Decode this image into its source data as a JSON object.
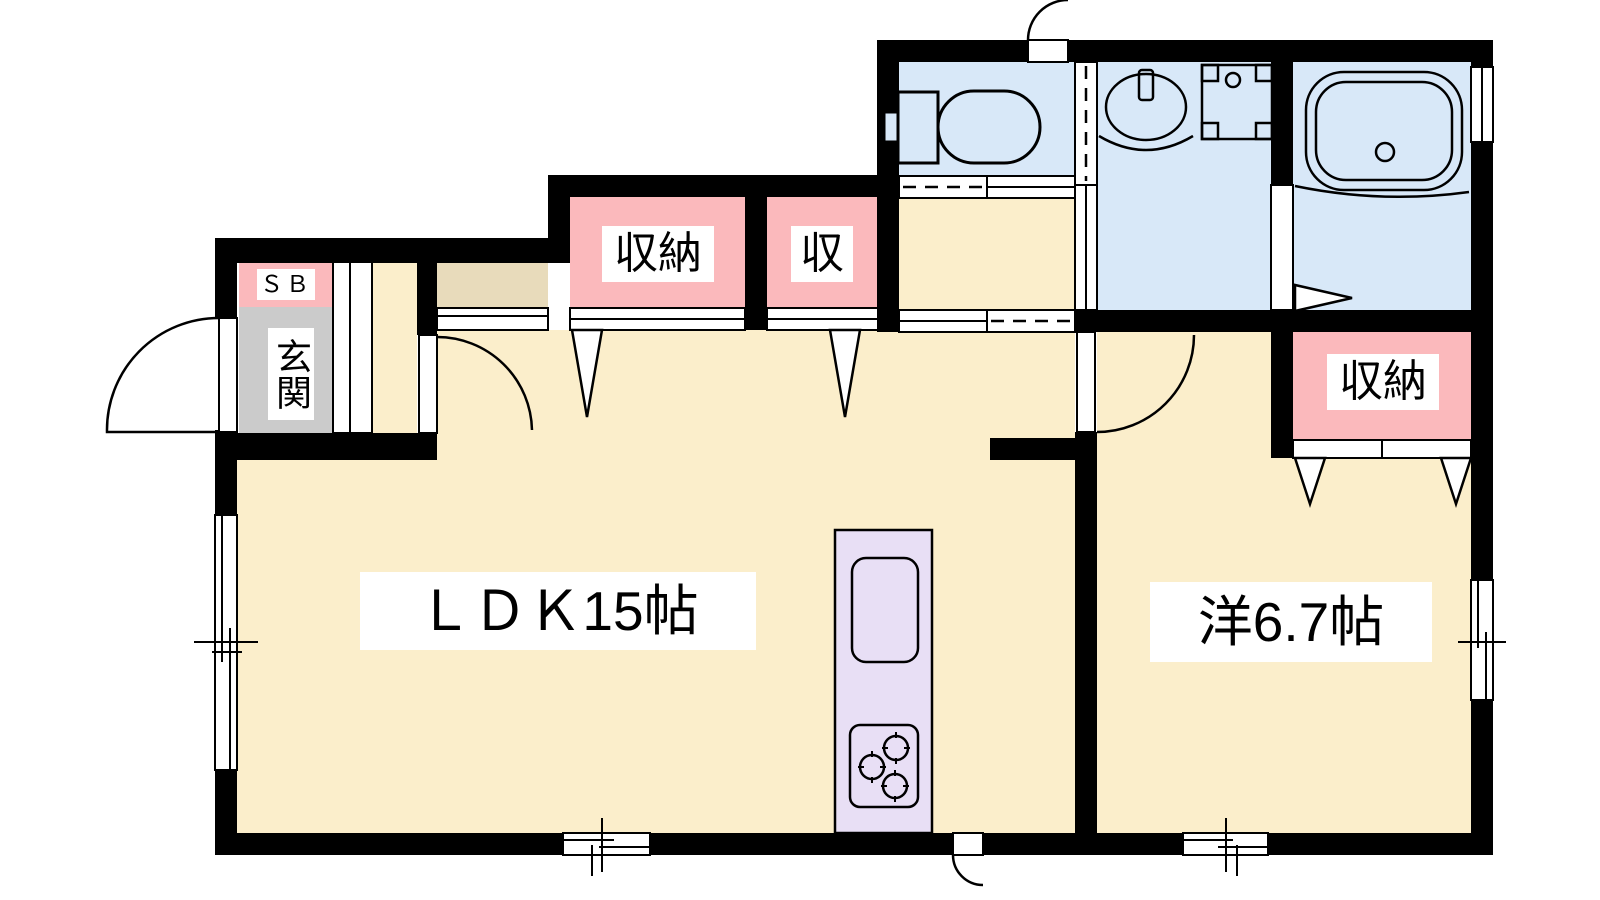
{
  "title": "1LDK floor plan",
  "colors": {
    "bg": "#FFFFFF",
    "wall": "#000000",
    "line": "#000000",
    "floor": "#FBEECB",
    "wet": "#D8E8F8",
    "closet": "#FBB9BC",
    "entrance": "#CBCBCB",
    "step": "#E8DBBB",
    "counter": "#E8DFF5",
    "label_bg": "#FFFFFF",
    "label_text": "#000000"
  },
  "rooms": {
    "ldk": {
      "label": "ＬＤＫ15帖"
    },
    "western_room": {
      "label": "洋6.7帖"
    },
    "closet_ldk": {
      "label": "収納"
    },
    "closet_small": {
      "label": "収"
    },
    "closet_western": {
      "label": "収納"
    },
    "entrance": {
      "label": "玄関"
    },
    "shoe_box": {
      "label": "ＳＢ"
    }
  },
  "fixtures": [
    "toilet",
    "washbasin",
    "washing-machine-pan",
    "bathtub",
    "kitchen-sink",
    "gas-stove",
    "shoe-cabinet-counter"
  ],
  "openings": {
    "hinged_doors": 5,
    "sliding_doors": 4,
    "folding_closet_doors": 4,
    "windows": 5
  }
}
